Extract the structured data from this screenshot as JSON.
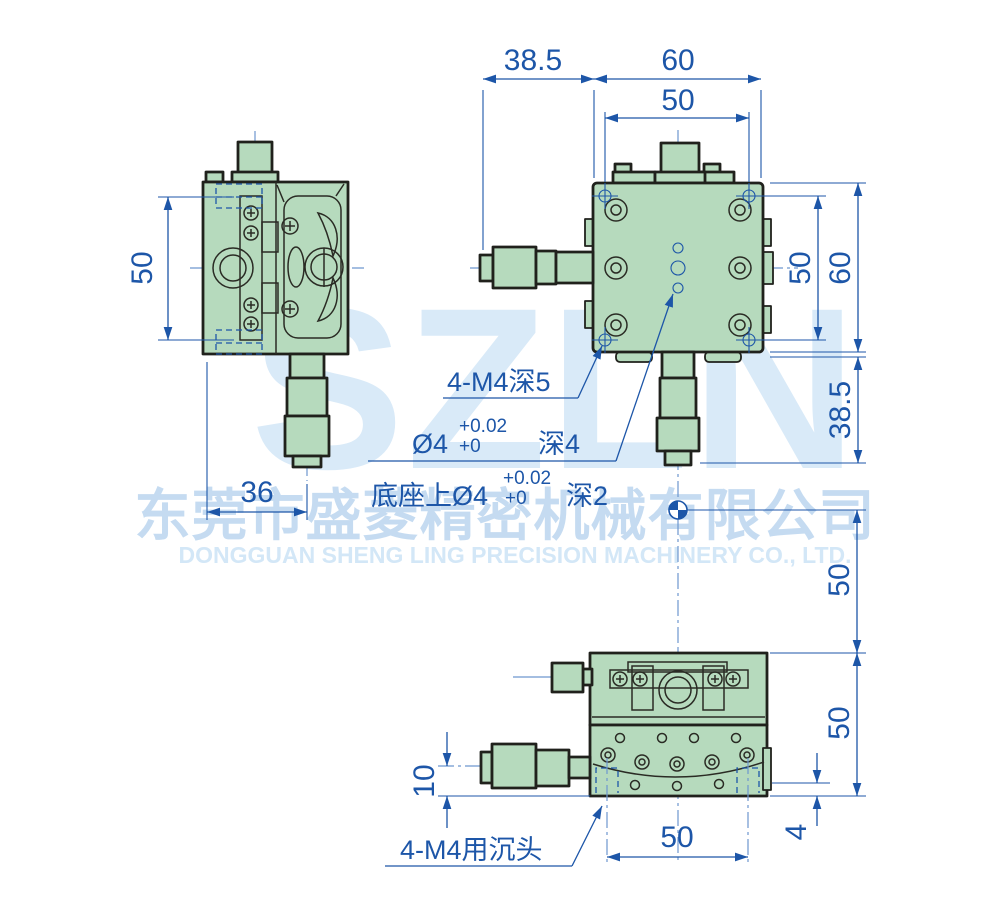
{
  "watermark": {
    "logo": "SZLN",
    "company_cn": "东莞市盛菱精密机械有限公司",
    "company_en": "DONGGUAN SHENG LING PRECISION MACHINERY CO., LTD."
  },
  "views": {
    "side": {
      "height": "50",
      "width_to_axis": "36"
    },
    "top": {
      "micrometer_offset": "38.5",
      "body_width": "60",
      "hole_spacing_x": "50",
      "hole_spacing_y": "50",
      "body_height": "60",
      "micrometer_offset_bottom": "38.5"
    },
    "front": {
      "axis_height": "10",
      "hole_height": "4",
      "hole_spacing": "50",
      "upper_span": "50",
      "lower_span": "50"
    }
  },
  "notes": {
    "corner_holes": "4-M4深5",
    "center_hole": {
      "dia": "Ø4",
      "tol_up": "+0.02",
      "tol_low": "+0",
      "depth": "深4"
    },
    "base_hole": {
      "dia": "底座上Ø4",
      "tol_up": "+0.02",
      "tol_low": "+0",
      "depth": "深2"
    },
    "countersink": "4-M4用沉头"
  },
  "colors": {
    "dimension_blue": "#1d56a8",
    "body_green": "#b6dabd",
    "outline_dark": "#20211c",
    "centerline_blue": "#6d97cf",
    "watermark_blue": "#d9eaf8"
  }
}
